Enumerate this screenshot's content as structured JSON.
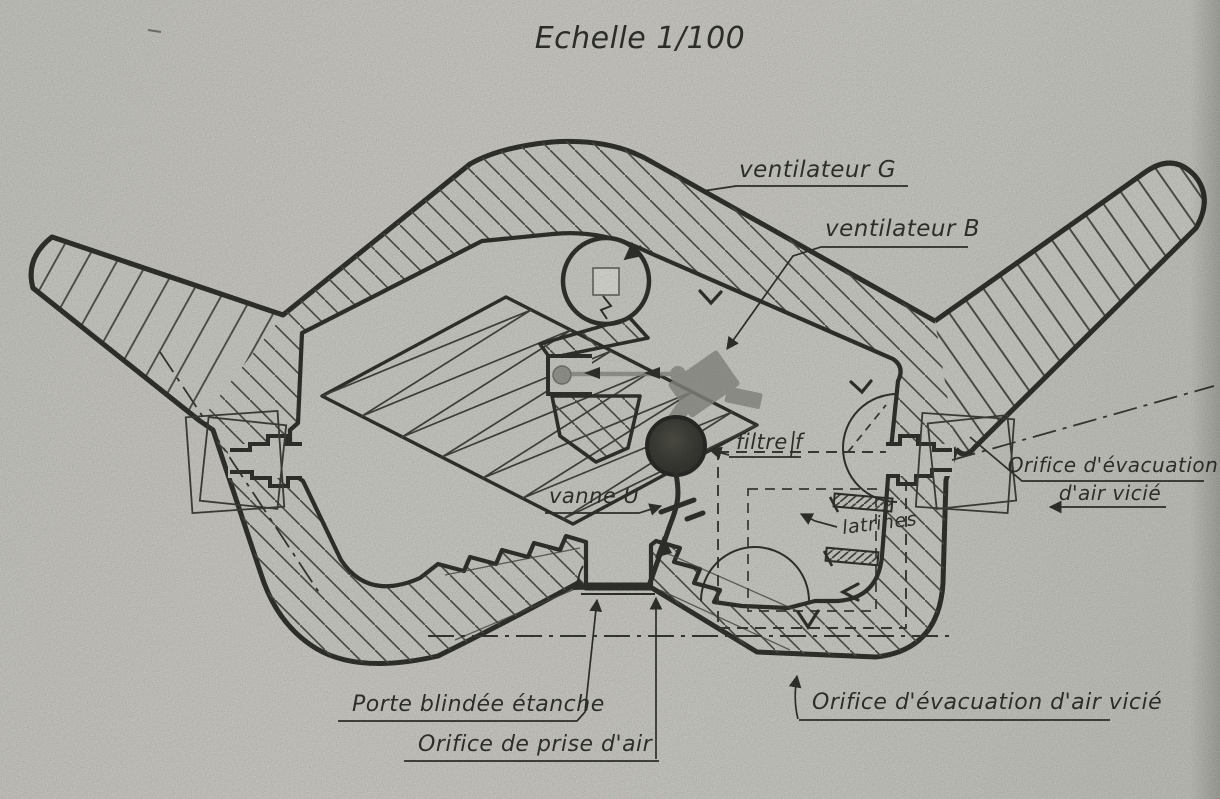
{
  "title": "Echelle 1/100",
  "labels": {
    "ventilateur_g": "ventilateur G",
    "ventilateur_b": "ventilateur B",
    "filtre_f": "filtre f",
    "vanne_u": "vanne U",
    "latrines": "latrines",
    "orifice_evacuation_right": {
      "line1": "Orifice d'évacuation",
      "line2": "d'air vicié"
    },
    "porte_blindee": "Porte blindée étanche",
    "orifice_prise_air": "Orifice de prise d'air",
    "orifice_evacuation_bottom": "Orifice d'évacuation d'air vicié"
  },
  "colors": {
    "paper": "#dcdcd6",
    "ink": "#1d1d1a",
    "hatch": "#3e3e3a",
    "device_gray": "#8e8e88",
    "filter_dark": "#2c2c28"
  }
}
